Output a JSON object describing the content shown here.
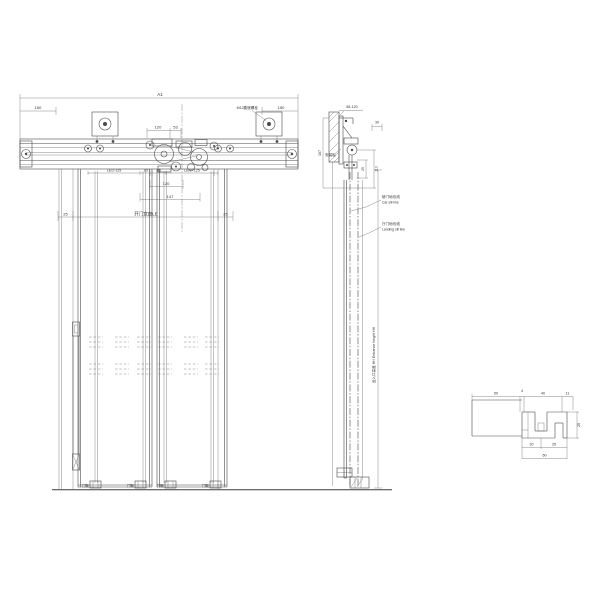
{
  "drawing": {
    "colors": {
      "line": "#4a4a4a",
      "text": "#333333",
      "background": "#ffffff"
    },
    "main_view": {
      "dim_overall": "A1",
      "dim_end_left": "150",
      "dim_end_right": "150",
      "note_bolt": "M12膨胀螺栓",
      "dim_120_top": "120",
      "dim_53": "53",
      "chain": [
        "LE/2-125",
        "85",
        "85",
        "LE/2+125"
      ],
      "dim_120_low": "120",
      "dim_147": "147",
      "dim_25_left": "25",
      "opening_label": "开门宽度LE",
      "dim_25_right": "25",
      "shoe_labels": [
        "门靴",
        "门靴",
        "门靴",
        "门靴"
      ]
    },
    "section_view": {
      "dim_top_gap": "85-120",
      "dim_30": "30",
      "dim_167": "167",
      "plate_label": "安装板",
      "dim_25": "25",
      "dim_110": "110",
      "car_sill_cn": "轿门地坎线",
      "car_sill_en": "Car sill line",
      "landing_sill_cn": "厅门地坎线",
      "landing_sill_en": "Landing sill line",
      "entrance_height_label": "出入口高度 HH  Entrance height HH"
    },
    "detail_view": {
      "dim_50": "50",
      "dim_4": "4",
      "dim_40": "40",
      "dim_11": "11",
      "dim_20": "20",
      "dim_25_bottom": "25",
      "dim_60": "60",
      "dim_25_right": "25"
    }
  }
}
